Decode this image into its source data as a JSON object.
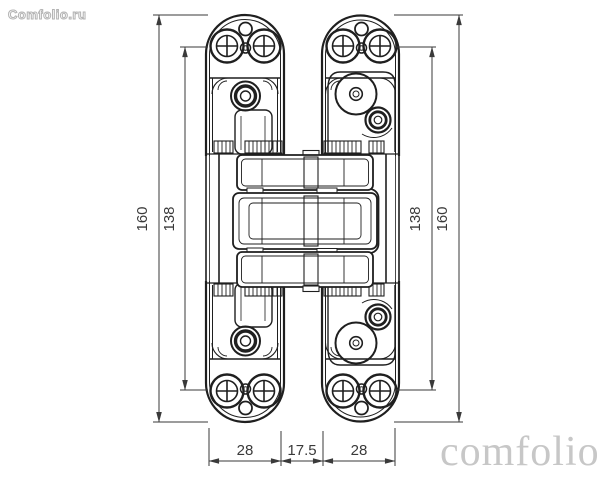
{
  "watermarks": {
    "top_left": "Comfolio.ru",
    "bottom_right": "comfolio"
  },
  "drawing": {
    "type": "technical-drawing",
    "subject": "concealed invisible door hinge, front elevation, two leaves with articulated center linkage",
    "dimensions": {
      "height_left_outer": "160",
      "height_left_inner": "138",
      "height_right_inner": "138",
      "height_right_outer": "160",
      "width_left_leaf": "28",
      "width_center_gap": "17.5",
      "width_right_leaf": "28"
    },
    "colors": {
      "background": "#ffffff",
      "drawing_lines": "#1f1f1f",
      "dimension_lines": "#3a3a3a",
      "watermark_outline": "#b3b3b3",
      "watermark_serif": "#c7c7c7"
    }
  }
}
